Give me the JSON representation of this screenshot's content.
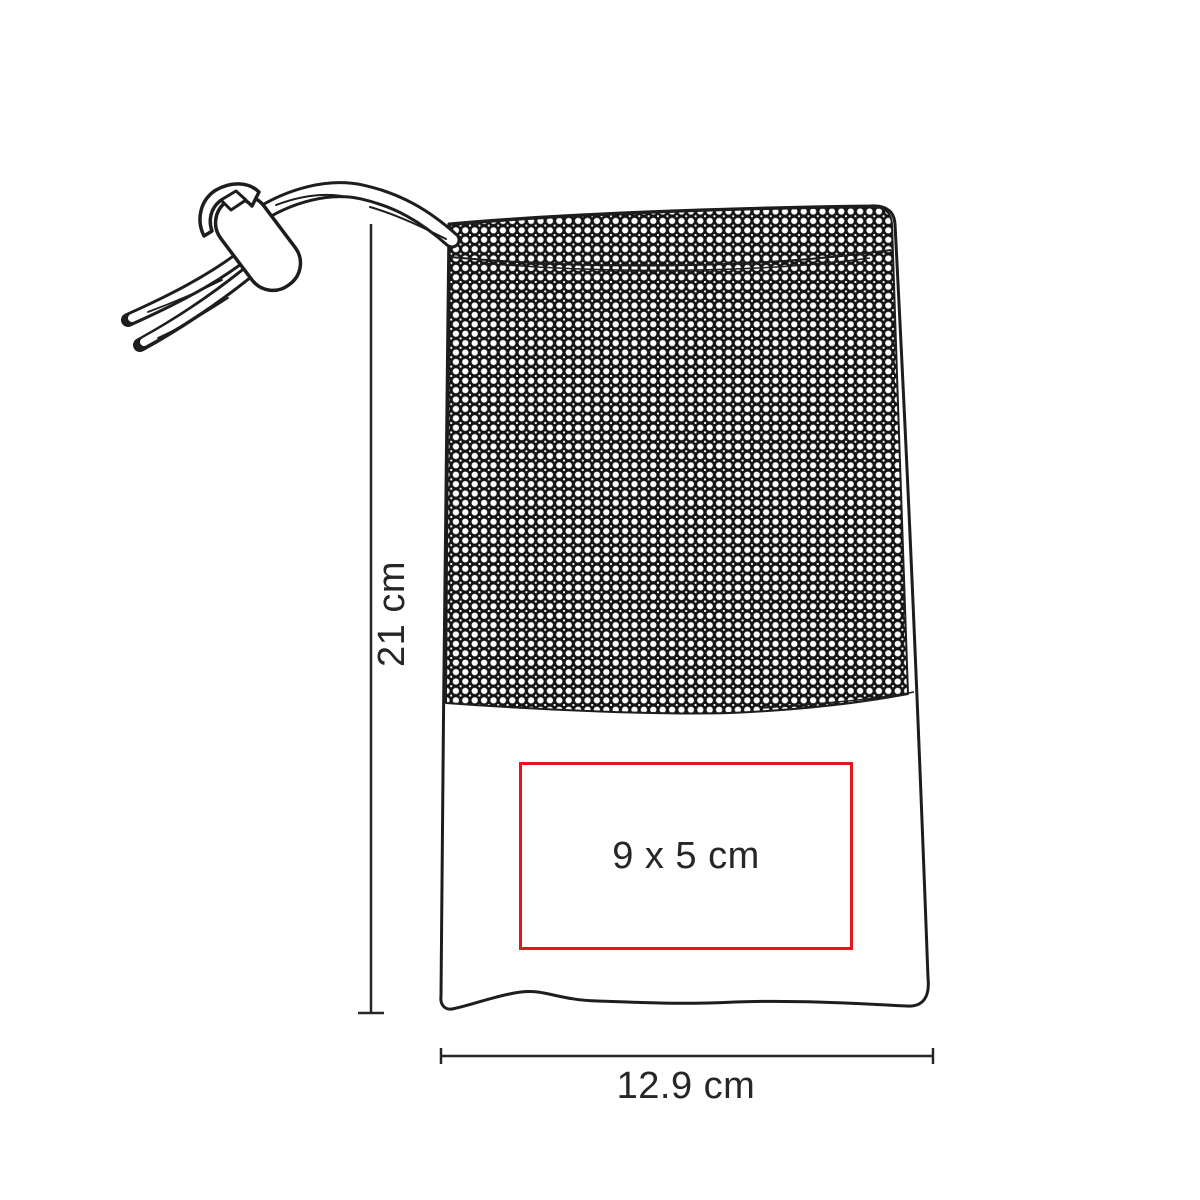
{
  "figure": {
    "name": "mesh-drawstring-pouch-line-drawing",
    "outline_color": "#1d1d1b",
    "background_color": "#ffffff"
  },
  "dimensions": {
    "height_label": "21 cm",
    "width_label": "12.9 cm"
  },
  "print_area": {
    "label": "9 x 5 cm",
    "border_color": "#e8131d"
  }
}
